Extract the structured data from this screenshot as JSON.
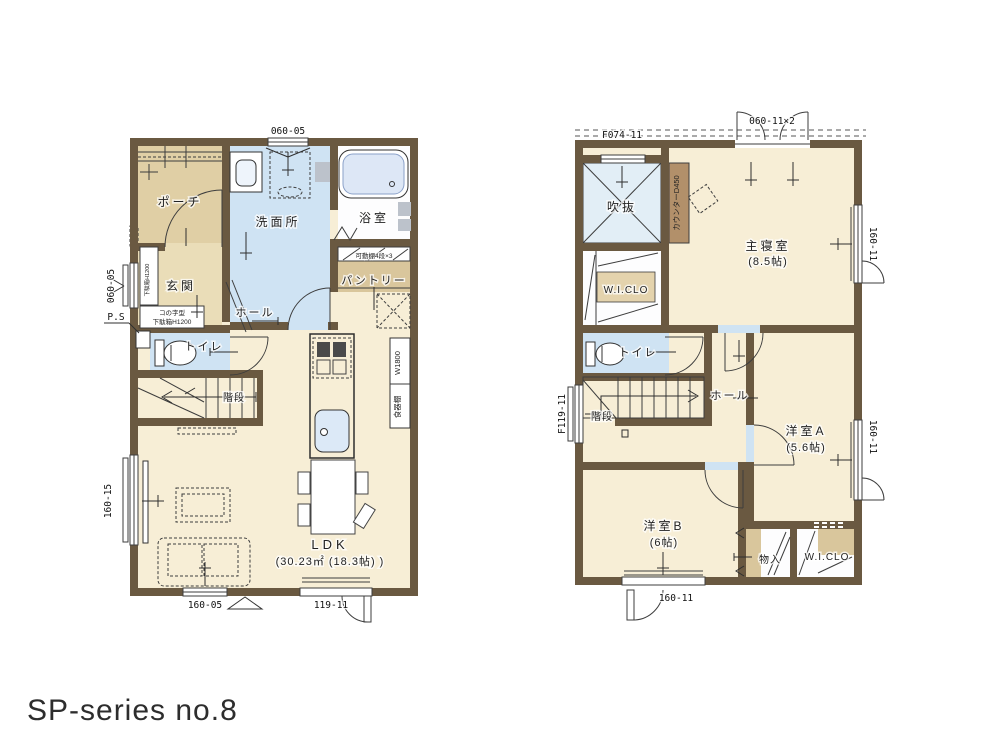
{
  "title": "SP-series no.8",
  "colors": {
    "wall": "#6a5941",
    "floor": "#f7eed6",
    "wet_area": "#cfe3f3",
    "porch": "#e0cfa5",
    "closet": "#d9c69c",
    "counter": "#b2906a",
    "void": "#e2eef6"
  },
  "floor1": {
    "rooms": {
      "porch": "ポーチ",
      "entrance": "玄関",
      "washroom": "洗面所",
      "bathroom": "浴室",
      "pantry": "パントリー",
      "pantry_note": "可動棚4段×3",
      "hall": "ホール",
      "toilet": "トイレ",
      "stairs": "階段",
      "ldk": "LDK",
      "ldk_size": "(30.23㎡ (18.3帖) )",
      "ps": "P.S",
      "cupboard": "食器棚",
      "cupboard_width": "W1800",
      "shoebox_line1": "コの字型",
      "shoebox_line2": "下駄箱H1200"
    },
    "dims": {
      "top_window": "060-05",
      "left_window": "060-05",
      "living_window": "160-15",
      "bottom_window": "160-05",
      "terrace_door": "119-11"
    }
  },
  "floor2": {
    "rooms": {
      "void": "吹抜",
      "counter": "カウンターD450",
      "wic_upper": "W.I.CLO",
      "master": "主寝室",
      "master_size": "(8.5帖)",
      "toilet": "トイレ",
      "stairs": "階段",
      "hall": "ホール",
      "room_a": "洋室A",
      "room_a_size": "(5.6帖)",
      "room_b": "洋室B",
      "room_b_size": "(6帖)",
      "storage": "物入",
      "wic_lower": "W.I.CLO"
    },
    "dims": {
      "window_f074": "F074-11",
      "window_master_top": "060-11×2",
      "window_master_right": "160-11",
      "window_room_a": "160-11",
      "window_room_b": "160-11",
      "window_stairs": "F119-11"
    }
  }
}
